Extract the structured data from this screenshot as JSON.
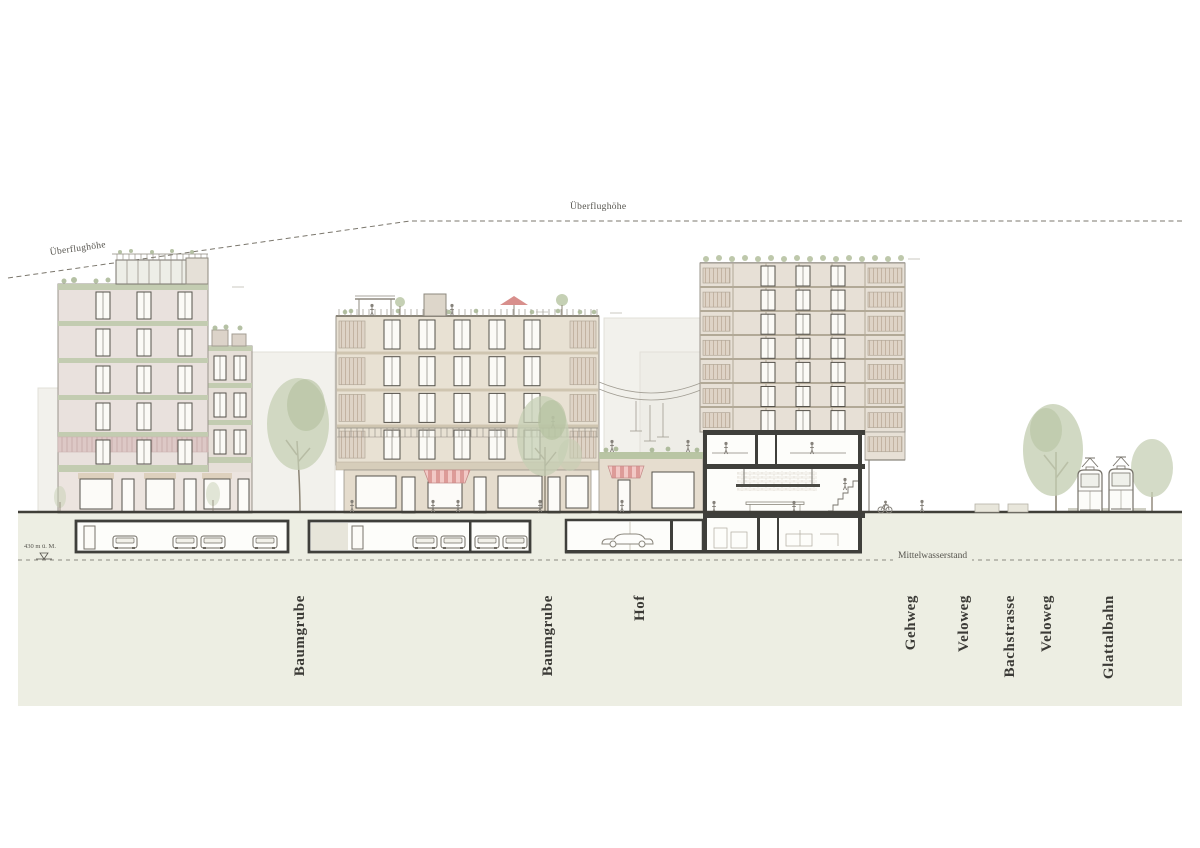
{
  "annotations": {
    "flight_height_left": "Überflughöhe",
    "flight_height_top": "Überflughöhe",
    "water_level": "Mittelwasserstand",
    "elevation_mark": "430 m ü. M."
  },
  "zone_labels": [
    {
      "id": "baumgrube-1",
      "label": "Baumgrube"
    },
    {
      "id": "baumgrube-2",
      "label": "Baumgrube"
    },
    {
      "id": "hof",
      "label": "Hof"
    },
    {
      "id": "gehweg",
      "label": "Gehweg"
    },
    {
      "id": "veloweg-1",
      "label": "Veloweg"
    },
    {
      "id": "bachstrasse",
      "label": "Bachstrasse"
    },
    {
      "id": "veloweg-2",
      "label": "Veloweg"
    },
    {
      "id": "glattalbahn",
      "label": "Glattalbahn"
    }
  ],
  "colors": {
    "paper": "#ffffff",
    "ground_fill": "#edeee3",
    "accent_green": "#c3ccb1",
    "facade_left": "#e9e1dd",
    "facade_middle": "#e8e1d3",
    "facade_right": "#e7e0d6",
    "awning_red": "#dd9b98",
    "section_poche": "#3f3f3b",
    "tree_green": "#c6cfb4",
    "label_text": "#3b3a36",
    "dashed_line": "#7b776d"
  }
}
